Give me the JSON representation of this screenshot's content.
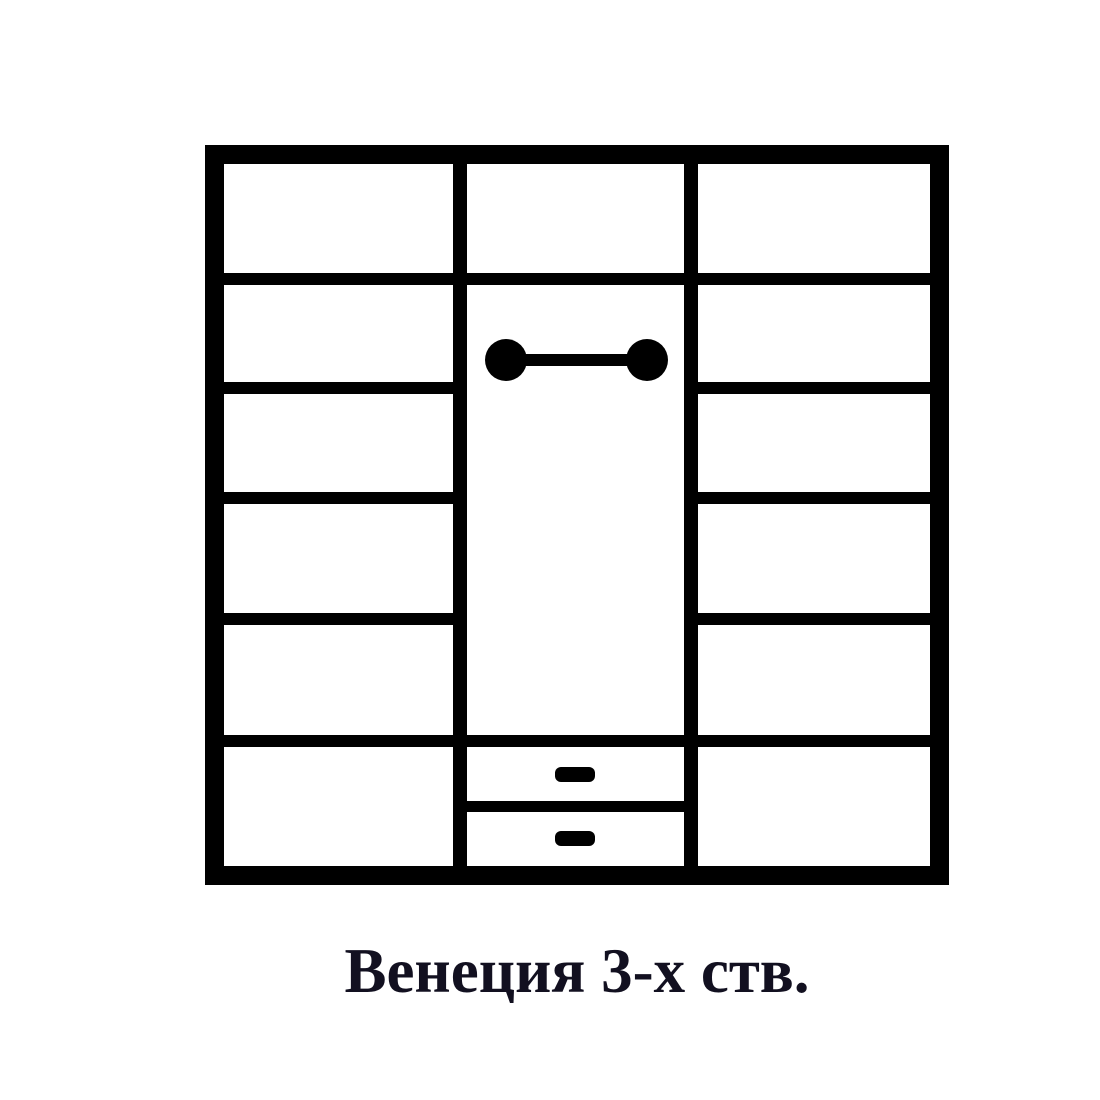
{
  "caption": {
    "text": "Венеция 3-х ств."
  },
  "colors": {
    "background": "#ffffff",
    "line": "#000000",
    "caption_text": "#121020"
  },
  "diagram": {
    "kind": "wardrobe-front-scheme",
    "model_name": "Венеция",
    "door_count_label": "3-х ств.",
    "sections": [
      {
        "name": "left",
        "compartments": 6,
        "shelf_lines": 5
      },
      {
        "name": "middle",
        "top_compartments": 1,
        "hanging_rod": true,
        "drawers": 2
      },
      {
        "name": "right",
        "compartments": 6,
        "shelf_lines": 5
      }
    ],
    "symbols": [
      "hanging-rod-icon",
      "drawer-handle-icon",
      "drawer-handle-icon"
    ]
  }
}
